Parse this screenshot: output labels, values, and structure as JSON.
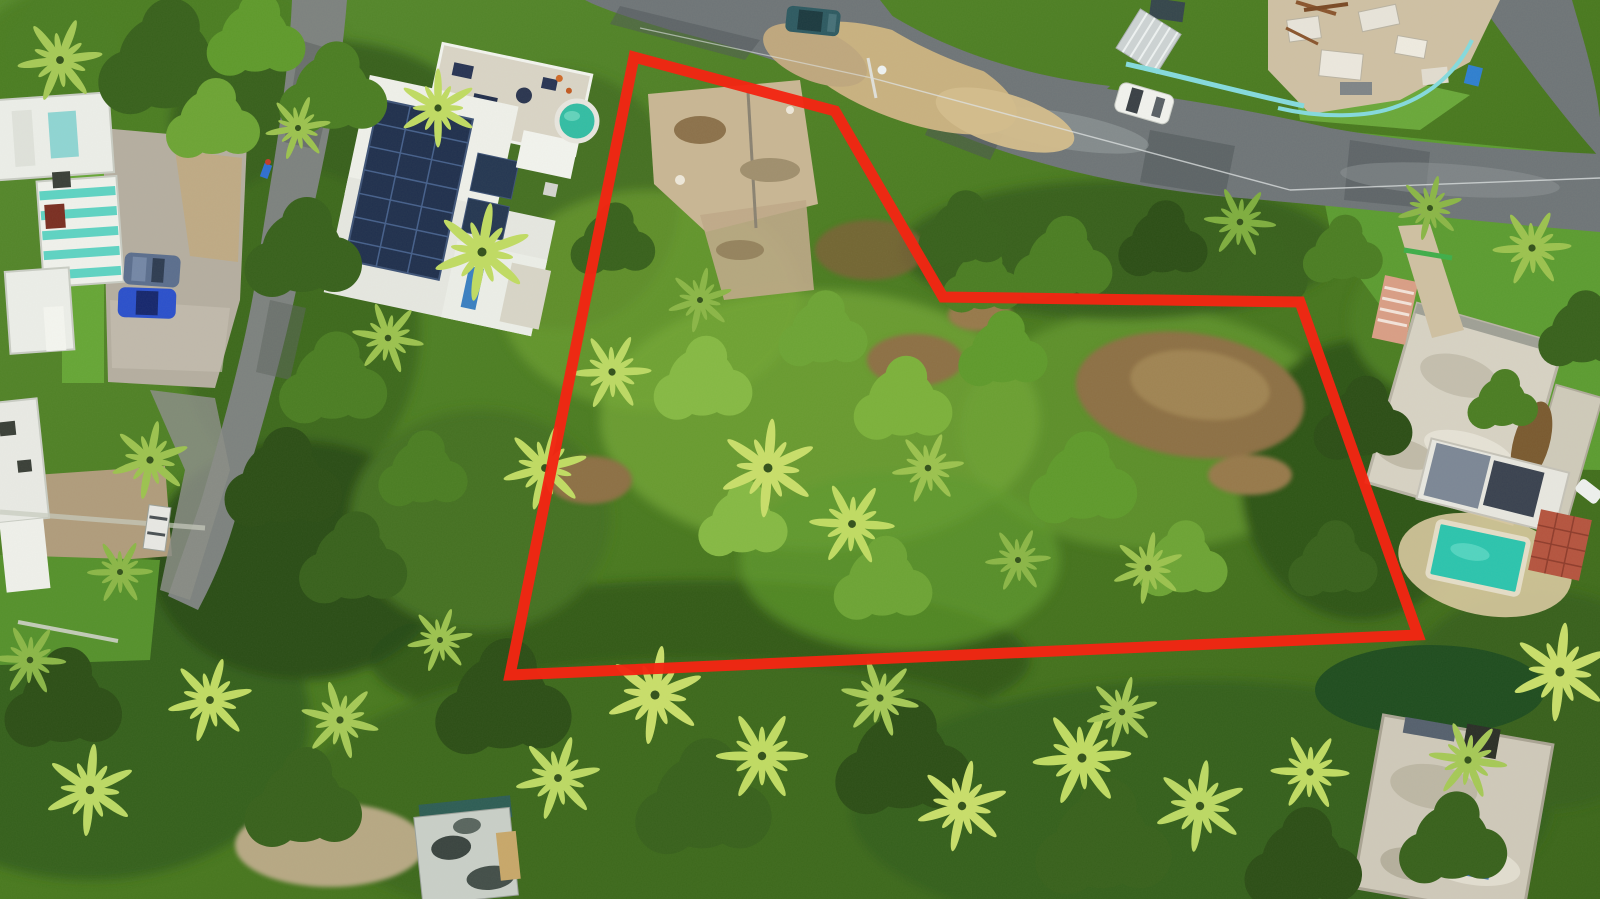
{
  "scene": {
    "title": "Aerial drone photo of a wooded residential lot outlined in red",
    "setting": "Tropical residential neighborhood with palm trees, modern houses, pools, roads and a vacant overgrown parcel marked by a red property-boundary overlay",
    "visible_text": "none"
  },
  "boundary": {
    "color": "#f22613",
    "stroke_width": 11,
    "points": [
      [
        634,
        57
      ],
      [
        835,
        111
      ],
      [
        943,
        297
      ],
      [
        1300,
        302
      ],
      [
        1418,
        635
      ],
      [
        510,
        675
      ]
    ]
  },
  "palette": {
    "canopy_dark": "#2c4e16",
    "canopy_mid": "#4b7d23",
    "canopy_light": "#7cb13b",
    "scrub_light": "#86b944",
    "palm_bright": "#c0db63",
    "lawn": "#5c9c31",
    "dirt": "#8d6f45",
    "sand": "#c9b180",
    "asphalt": "#6f7578",
    "asphalt_worn": "#969c9e",
    "concrete": "#b5aea0",
    "roof_white": "#eceee9",
    "roof_weathered": "#d7d2c4",
    "solar_navy": "#20304e",
    "stripe_teal": "#5ed3c3",
    "jacuzzi_teal": "#33bda4",
    "pool_teal": "#2cc4ae",
    "brick_red": "#b5543f",
    "salmon": "#d99e86",
    "fence_teal": "#85dade"
  },
  "features": {
    "roads": [
      "main road curving from top-center to right edge",
      "branch road to top-right corner",
      "left street with concrete parking pad",
      "dirt shoulder inside road bend"
    ],
    "buildings": [
      "modern solar-panel house with rooftop terrace (top-left)",
      "teal-striped row houses (left edge)",
      "construction/rubble site (top-right)",
      "weathered-roof house (right-middle)",
      "pool house with rectangular teal pool and brick patio (right)",
      "weathered-roof house (bottom-right)",
      "small mottled-roof shed (bottom-center)"
    ],
    "vehicles": [
      {
        "name": "white-car-on-road",
        "color": "#f1f2ee"
      },
      {
        "name": "teal-car-top",
        "color": "#2e5a62"
      },
      {
        "name": "gray-car-parking",
        "color": "#5b6e8e"
      },
      {
        "name": "blue-car-parking",
        "color": "#2b50cc"
      },
      {
        "name": "white-truck-left",
        "color": "#e8e8e4"
      }
    ],
    "pools": [
      {
        "name": "round-jacuzzi",
        "color": "#33bda4"
      },
      {
        "name": "rect-pool-east",
        "color": "#2cc4ae"
      },
      {
        "name": "small-blue-pool-southeast",
        "color": "#3f72b5"
      }
    ]
  }
}
